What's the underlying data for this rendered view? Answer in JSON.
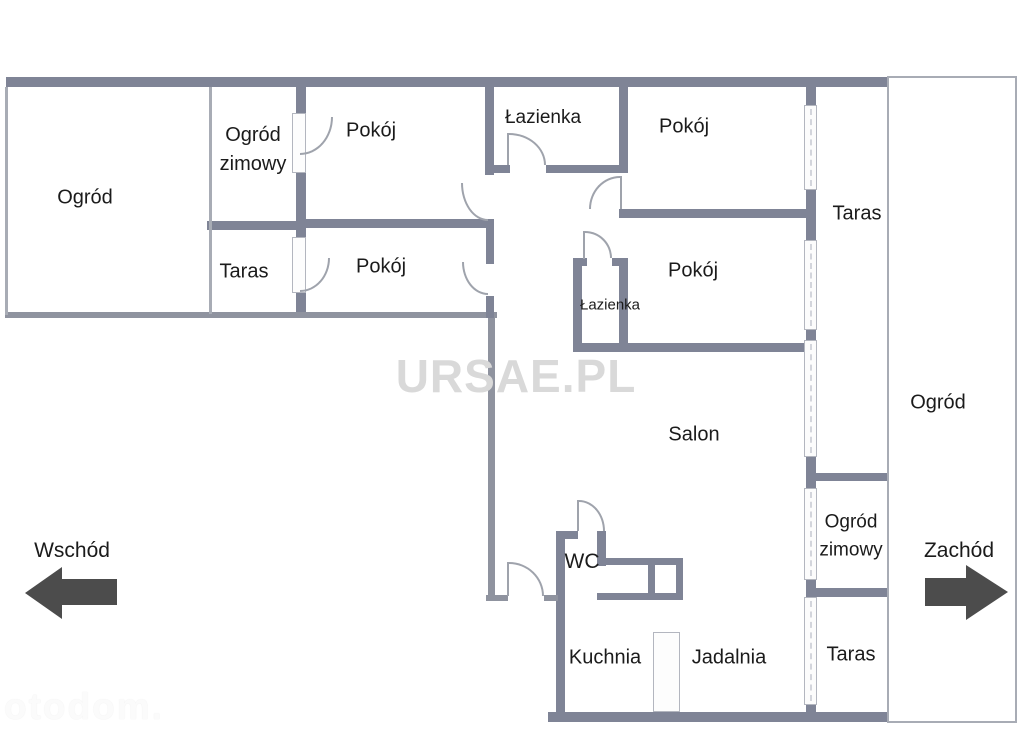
{
  "rooms": {
    "ogrod_left": "Ogród",
    "ogrod_zimowy_left": "Ogród zimowy",
    "taras_left": "Taras",
    "pokoj_top_left": "Pokój",
    "pokoj_mid_left": "Pokój",
    "lazienka_top": "Łazienka",
    "pokoj_top_right": "Pokój",
    "taras_right_top": "Taras",
    "pokoj_mid_right": "Pokój",
    "lazienka_small": "Łazienka",
    "salon": "Salon",
    "ogrod_right": "Ogród",
    "wc": "WC",
    "ogrod_zimowy_right": "Ogród zimowy",
    "kuchnia": "Kuchnia",
    "jadalnia": "Jadalnia",
    "taras_right_bottom": "Taras"
  },
  "compass": {
    "east": "Wschód",
    "west": "Zachód"
  },
  "watermarks": {
    "center": "URSAE.PL",
    "corner": "otodom."
  },
  "colors": {
    "wall": "#7f8496",
    "wall_mid": "#8f939f",
    "thin": "#a8acb5",
    "arc": "#9fa3ac",
    "arrow": "#4c4c4c",
    "text": "#1b1b1b",
    "watermark": "#d9d9d9"
  }
}
